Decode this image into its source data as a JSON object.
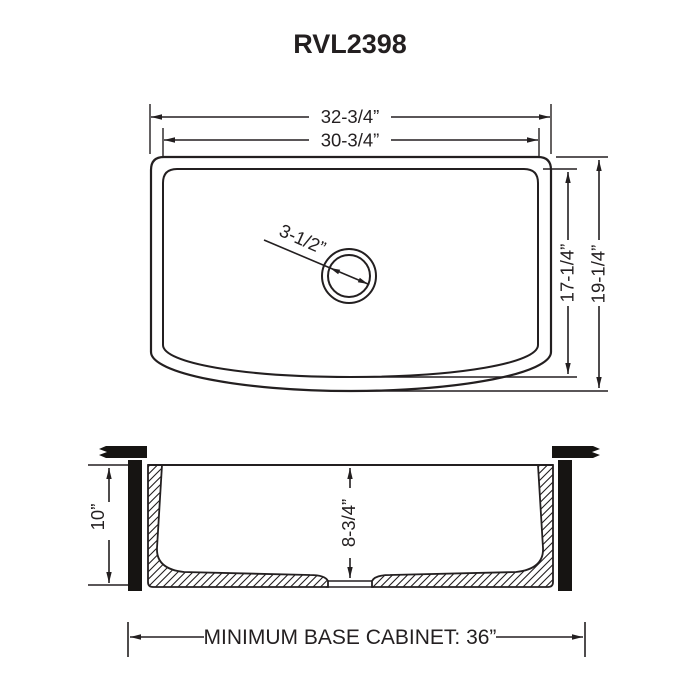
{
  "title": "RVL2398",
  "colors": {
    "line": "#231f20",
    "background": "#ffffff"
  },
  "top_view": {
    "outer_width": "32-3/4”",
    "inner_width": "30-3/4”",
    "drain_diameter": "3-1/2”",
    "inner_depth": "17-1/4”",
    "outer_depth": "19-1/4”"
  },
  "section_view": {
    "apron_height": "10”",
    "bowl_depth": "8-3/4”",
    "cabinet_note": "MINIMUM BASE CABINET: 36”"
  }
}
